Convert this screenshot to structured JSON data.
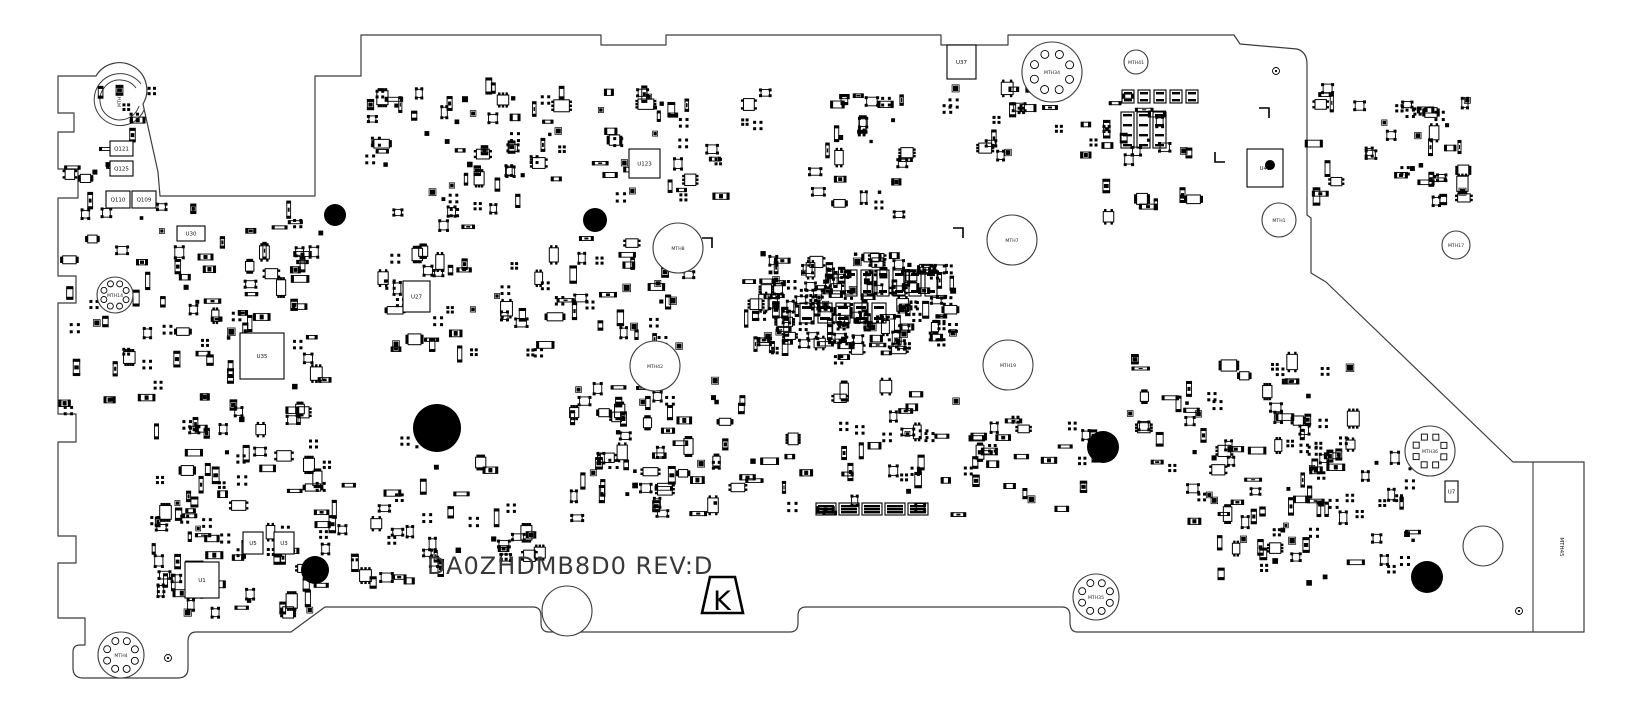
{
  "board": {
    "title": "DA0ZHDMB8D0 REV:D",
    "certification_mark": "K",
    "edge_tab_label": "MTH45",
    "colors": {
      "ink": "#000000",
      "outline": "#3c3c3c",
      "background": "#ffffff",
      "title": "#383838"
    },
    "outline_path": "M 58 76 L 96 76 A 27 27 0 1 1 143 104 L 158 172 L 160 196 L 315 196 L 315 76 L 361 76 L 361 35 L 601 35 L 601 45 L 666 45 L 666 35 L 941 35 L 941 45 L 1008 45 L 1008 35 L 1234 35 L 1240 44 L 1297 49 Q 1307 52 1307 64 L 1307 215 L 1311 218 L 1311 273 L 1326 282 L 1513 462 L 1584 462 L 1584 632 L 1077 632 Q 1070 632 1070 622 L 1070 616 Q 1070 607 1062 607 L 806 607 Q 798 607 798 616 L 798 623 Q 798 632 790 632 L 549 632 Q 541 632 541 623 L 541 616 Q 541 607 533 607 L 325 607 L 291 632 L 196 632 Q 188 632 188 642 L 188 668 Q 188 678 178 678 L 83 678 Q 73 678 73 668 L 73 652 Q 73 645 80 645 L 85 645 L 85 618 L 58 618 L 58 563 L 76 563 L 76 536 L 58 536 L 58 442 L 76 442 L 76 414 L 58 414 L 58 303 L 76 303 L 76 276 L 58 276 L 58 198 L 78 198 L 78 169 L 58 169 L 58 132 L 74 132 L 74 113 L 58 113 Z",
    "cutout_arcs": [
      "M 141 84 A 26 26 0 1 0 144 110",
      "M 136 88 A 20 20 0 1 0 139 106"
    ],
    "tab_divider": {
      "x1": 1533,
      "y1": 462,
      "x2": 1533,
      "y2": 632
    },
    "k_mark": {
      "points": "710,577 735,577 743,613 702,613",
      "cx": 722,
      "cy": 601
    },
    "edge_tab_label_pos": {
      "x": 1560,
      "y": 547
    }
  },
  "mount_holes": [
    {
      "label": "MTH10",
      "x": 119,
      "y": 99,
      "r": 0,
      "pads": 0,
      "label_rot": -90
    },
    {
      "label": "MTH14",
      "x": 115,
      "y": 295,
      "r": 18,
      "pads": 8,
      "pad_ring": 12,
      "pad_r": 3
    },
    {
      "label": "MTH4",
      "x": 121,
      "y": 655,
      "r": 23,
      "pads": 8,
      "pad_ring": 15,
      "pad_r": 3.5
    },
    {
      "label": "MTH34",
      "x": 1052,
      "y": 72,
      "r": 30,
      "pads": 8,
      "pad_ring": 19,
      "pad_r": 4
    },
    {
      "label": "MTH41",
      "x": 1136,
      "y": 62,
      "r": 12,
      "pads": 0
    },
    {
      "label": "MTH1",
      "x": 1279,
      "y": 220,
      "r": 17,
      "pads": 0
    },
    {
      "label": "MTH8",
      "x": 678,
      "y": 248,
      "r": 25,
      "pads": 0
    },
    {
      "label": "MTH7",
      "x": 1012,
      "y": 240,
      "r": 25,
      "pads": 0
    },
    {
      "label": "MTH42",
      "x": 655,
      "y": 366,
      "r": 25,
      "pads": 0
    },
    {
      "label": "MTH19",
      "x": 1008,
      "y": 365,
      "r": 25,
      "pads": 0
    },
    {
      "label": "MTH17",
      "x": 1456,
      "y": 245,
      "r": 14,
      "pads": 0
    },
    {
      "label": "MTH36",
      "x": 1430,
      "y": 451,
      "r": 25,
      "pads": 8,
      "pad_ring": 15,
      "pad_r": 3,
      "square_pads": true
    },
    {
      "label": "MTH35",
      "x": 1096,
      "y": 597,
      "r": 23,
      "pads": 8,
      "pad_ring": 15,
      "pad_r": 3.5
    },
    {
      "label": "",
      "x": 1483,
      "y": 546,
      "r": 20,
      "pads": 0
    },
    {
      "label": "",
      "x": 567,
      "y": 611,
      "r": 25,
      "pads": 0
    }
  ],
  "fiducials": [
    {
      "x": 335,
      "y": 215,
      "r": 11
    },
    {
      "x": 595,
      "y": 220,
      "r": 12
    },
    {
      "x": 437,
      "y": 428,
      "r": 24
    },
    {
      "x": 315,
      "y": 570,
      "r": 14
    },
    {
      "x": 1103,
      "y": 447,
      "r": 16
    },
    {
      "x": 1427,
      "y": 577,
      "r": 16
    },
    {
      "x": 1270,
      "y": 165,
      "r": 5
    }
  ],
  "targets": [
    {
      "x": 1276,
      "y": 71
    },
    {
      "x": 168,
      "y": 658
    },
    {
      "x": 1519,
      "y": 611
    }
  ],
  "components": [
    {
      "label": "Q121",
      "x": 110,
      "y": 141,
      "w": 23,
      "h": 15
    },
    {
      "label": "Q125",
      "x": 110,
      "y": 161,
      "w": 23,
      "h": 15
    },
    {
      "label": "Q110",
      "x": 106,
      "y": 191,
      "w": 24,
      "h": 17
    },
    {
      "label": "Q109",
      "x": 132,
      "y": 191,
      "w": 24,
      "h": 17
    },
    {
      "label": "U30",
      "x": 177,
      "y": 226,
      "w": 28,
      "h": 15
    },
    {
      "label": "U35",
      "x": 240,
      "y": 333,
      "w": 44,
      "h": 46
    },
    {
      "label": "U27",
      "x": 403,
      "y": 281,
      "w": 27,
      "h": 31
    },
    {
      "label": "U123",
      "x": 629,
      "y": 149,
      "w": 31,
      "h": 29
    },
    {
      "label": "U37",
      "x": 947,
      "y": 45,
      "w": 29,
      "h": 34
    },
    {
      "label": "U45",
      "x": 1247,
      "y": 149,
      "w": 36,
      "h": 38
    },
    {
      "label": "U1",
      "x": 185,
      "y": 562,
      "w": 34,
      "h": 36
    },
    {
      "label": "U5",
      "x": 243,
      "y": 532,
      "w": 20,
      "h": 22
    },
    {
      "label": "U3",
      "x": 274,
      "y": 532,
      "w": 20,
      "h": 22
    },
    {
      "label": "U7",
      "x": 1445,
      "y": 481,
      "w": 13,
      "h": 21
    }
  ],
  "connectors": [
    {
      "x": 1121,
      "y": 112,
      "w": 13,
      "h": 36,
      "bars": 4
    },
    {
      "x": 1137,
      "y": 112,
      "w": 13,
      "h": 36,
      "bars": 4
    },
    {
      "x": 1153,
      "y": 112,
      "w": 13,
      "h": 36,
      "bars": 4
    },
    {
      "x": 1122,
      "y": 90,
      "w": 12,
      "h": 13,
      "bars": 2
    },
    {
      "x": 1138,
      "y": 90,
      "w": 12,
      "h": 13,
      "bars": 2
    },
    {
      "x": 1154,
      "y": 90,
      "w": 12,
      "h": 13,
      "bars": 2
    },
    {
      "x": 1170,
      "y": 90,
      "w": 12,
      "h": 13,
      "bars": 2
    },
    {
      "x": 1186,
      "y": 90,
      "w": 12,
      "h": 13,
      "bars": 2
    },
    {
      "x": 816,
      "y": 503,
      "w": 20,
      "h": 12,
      "bars": 3
    },
    {
      "x": 839,
      "y": 503,
      "w": 20,
      "h": 12,
      "bars": 3
    },
    {
      "x": 862,
      "y": 503,
      "w": 20,
      "h": 12,
      "bars": 3
    },
    {
      "x": 885,
      "y": 503,
      "w": 20,
      "h": 12,
      "bars": 3
    },
    {
      "x": 908,
      "y": 503,
      "w": 20,
      "h": 12,
      "bars": 3
    }
  ],
  "bga_rows": [
    {
      "x0": 845,
      "y": 270,
      "dx": 16,
      "n": 6,
      "w": 12,
      "h": 26
    },
    {
      "x0": 800,
      "y": 303,
      "dx": 18,
      "n": 5,
      "w": 14,
      "h": 20
    }
  ],
  "corner_marks": [
    "M 712 248 L 712 238 L 702 238",
    "M 953 228 L 963 228 L 963 238",
    "M 1259 108 L 1269 108 L 1269 118",
    "M 1215 152 L 1215 162 L 1225 162"
  ],
  "clusters": [
    {
      "x": 370,
      "y": 85,
      "w": 195,
      "h": 150,
      "n": 65,
      "seed": 11
    },
    {
      "x": 600,
      "y": 88,
      "w": 170,
      "h": 115,
      "n": 38,
      "seed": 12
    },
    {
      "x": 800,
      "y": 85,
      "w": 110,
      "h": 130,
      "n": 30,
      "seed": 13
    },
    {
      "x": 945,
      "y": 88,
      "w": 115,
      "h": 75,
      "n": 18,
      "seed": 14
    },
    {
      "x": 1080,
      "y": 95,
      "w": 115,
      "h": 125,
      "n": 26,
      "seed": 15
    },
    {
      "x": 1300,
      "y": 88,
      "w": 170,
      "h": 115,
      "n": 32,
      "seed": 16
    },
    {
      "x": 62,
      "y": 85,
      "w": 95,
      "h": 115,
      "n": 14,
      "seed": 17
    },
    {
      "x": 62,
      "y": 200,
      "w": 265,
      "h": 215,
      "n": 95,
      "seed": 18
    },
    {
      "x": 380,
      "y": 248,
      "w": 180,
      "h": 112,
      "n": 42,
      "seed": 19
    },
    {
      "x": 560,
      "y": 238,
      "w": 130,
      "h": 118,
      "n": 30,
      "seed": 20
    },
    {
      "x": 745,
      "y": 253,
      "w": 210,
      "h": 92,
      "n": 150,
      "seed": 21
    },
    {
      "x": 755,
      "y": 332,
      "w": 195,
      "h": 28,
      "n": 22,
      "seed": 22
    },
    {
      "x": 560,
      "y": 380,
      "w": 200,
      "h": 140,
      "n": 40,
      "seed": 23
    },
    {
      "x": 765,
      "y": 378,
      "w": 195,
      "h": 140,
      "n": 40,
      "seed": 24
    },
    {
      "x": 140,
      "y": 418,
      "w": 190,
      "h": 145,
      "n": 70,
      "seed": 25
    },
    {
      "x": 330,
      "y": 440,
      "w": 190,
      "h": 105,
      "n": 24,
      "seed": 26
    },
    {
      "x": 955,
      "y": 418,
      "w": 145,
      "h": 112,
      "n": 30,
      "seed": 27
    },
    {
      "x": 1130,
      "y": 355,
      "w": 230,
      "h": 128,
      "n": 55,
      "seed": 28
    },
    {
      "x": 1190,
      "y": 488,
      "w": 225,
      "h": 95,
      "n": 45,
      "seed": 29
    },
    {
      "x": 1300,
      "y": 418,
      "w": 115,
      "h": 92,
      "n": 24,
      "seed": 30
    },
    {
      "x": 425,
      "y": 520,
      "w": 120,
      "h": 45,
      "n": 12,
      "seed": 31
    },
    {
      "x": 1408,
      "y": 88,
      "w": 60,
      "h": 115,
      "n": 12,
      "seed": 32
    },
    {
      "x": 150,
      "y": 560,
      "w": 180,
      "h": 55,
      "n": 22,
      "seed": 33
    },
    {
      "x": 300,
      "y": 548,
      "w": 180,
      "h": 40,
      "n": 14,
      "seed": 34
    },
    {
      "x": 600,
      "y": 395,
      "w": 120,
      "h": 125,
      "n": 28,
      "seed": 35
    }
  ]
}
